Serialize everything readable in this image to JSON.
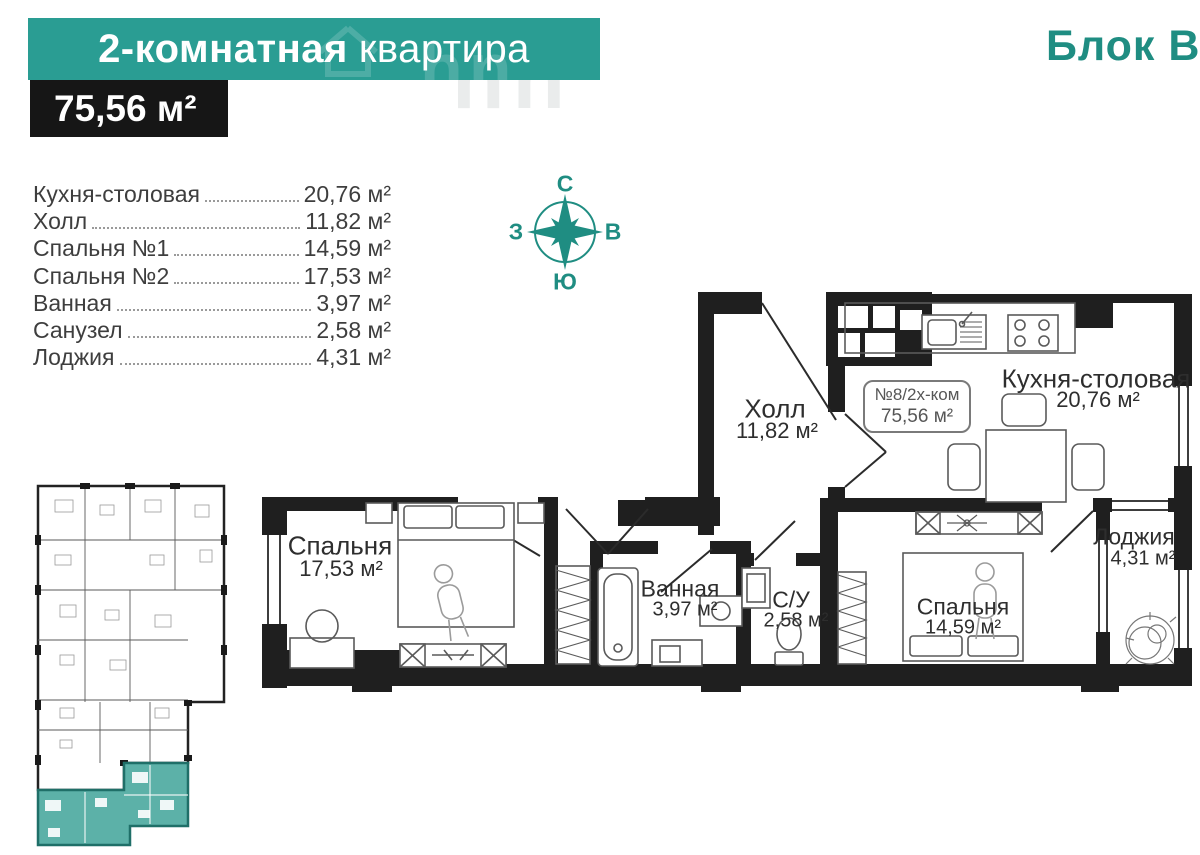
{
  "header": {
    "title_bold": "2-комнатная",
    "title_rest": "квартира",
    "area_badge": "75,56 м²",
    "block_label": "Блок В",
    "watermark": "hn"
  },
  "legend": {
    "rows": [
      {
        "name": "Кухня-столовая",
        "value": "20,76 м²"
      },
      {
        "name": "Холл",
        "value": "11,82 м²"
      },
      {
        "name": "Спальня №1",
        "value": "14,59 м²"
      },
      {
        "name": "Спальня №2",
        "value": "17,53 м²"
      },
      {
        "name": "Ванная",
        "value": "3,97 м²"
      },
      {
        "name": "Санузел",
        "value": "2,58 м²"
      },
      {
        "name": "Лоджия",
        "value": "4,31 м²"
      }
    ]
  },
  "compass": {
    "north": "С",
    "east": "В",
    "south": "Ю",
    "west": "З"
  },
  "plan": {
    "unit_box": {
      "line1": "№8/2х-ком",
      "line2": "75,56 м²"
    },
    "rooms": {
      "hall": {
        "name": "Холл",
        "area": "11,82 м²"
      },
      "kitchen": {
        "name": "Кухня-столовая",
        "area": "20,76 м²"
      },
      "bedroom_large": {
        "name": "Спальня",
        "area": "17,53 м²"
      },
      "bathroom": {
        "name": "Ванная",
        "area": "3,97 м²"
      },
      "wc": {
        "name": "С/У",
        "area": "2,58 м²"
      },
      "bedroom_small": {
        "name": "Спальня",
        "area": "14,59 м²"
      },
      "loggia": {
        "name": "Лоджия",
        "area": "4,31 м²"
      }
    }
  },
  "colors": {
    "teal": "#2a9d93",
    "teal_dark": "#1f8d82",
    "wall": "#1f1f1f",
    "mini_highlight": "#5cb1a8"
  }
}
